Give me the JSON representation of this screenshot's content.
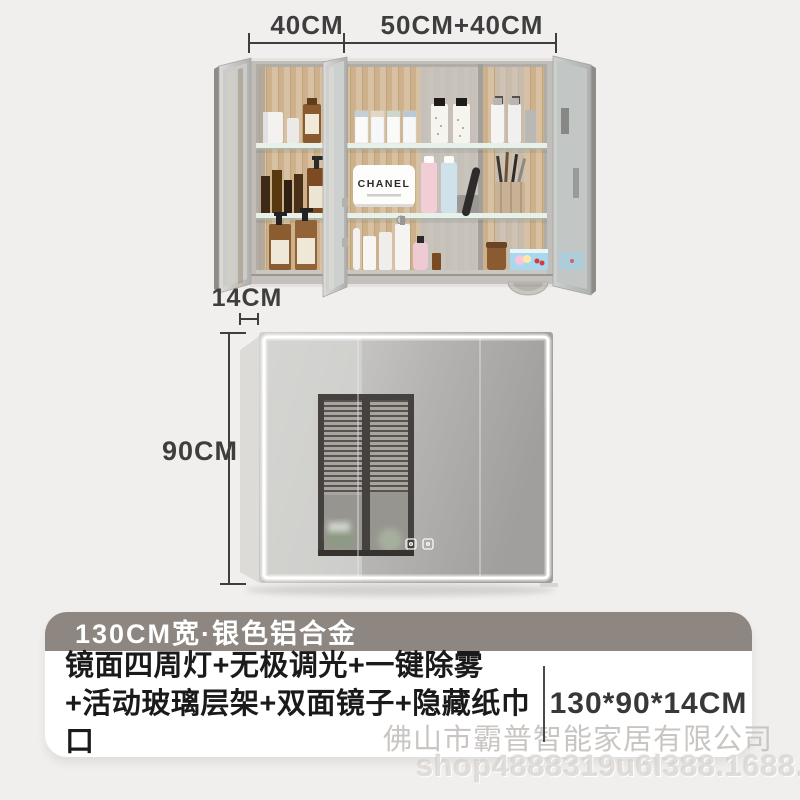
{
  "colors": {
    "page_bg": "#f1efed",
    "card_header_bg": "#8d8681",
    "dimension_text": "#3e3e3e",
    "watermark_gray": "#c9c5c2",
    "led_strip": "#ffffff"
  },
  "dimensions": {
    "top_left_width": "40CM",
    "top_right_width": "50CM+40CM",
    "depth": "14CM",
    "height": "90CM"
  },
  "open_cabinet": {
    "brand_box_label": "CHANEL"
  },
  "info_card": {
    "header": "130CM宽·银色铝合金",
    "feature_line1": "镜面四周灯+无极调光+一键除雾",
    "feature_line2": "+活动玻璃层架+双面镜子+隐藏纸巾口",
    "size": "130*90*14CM"
  },
  "watermarks": {
    "company": "佛山市霸普智能家居有限公司",
    "shop_url": "shop4888319u6l388.1688.com"
  },
  "icons": {
    "touch_icons": [
      "defog-touch-icon",
      "light-touch-icon"
    ]
  }
}
